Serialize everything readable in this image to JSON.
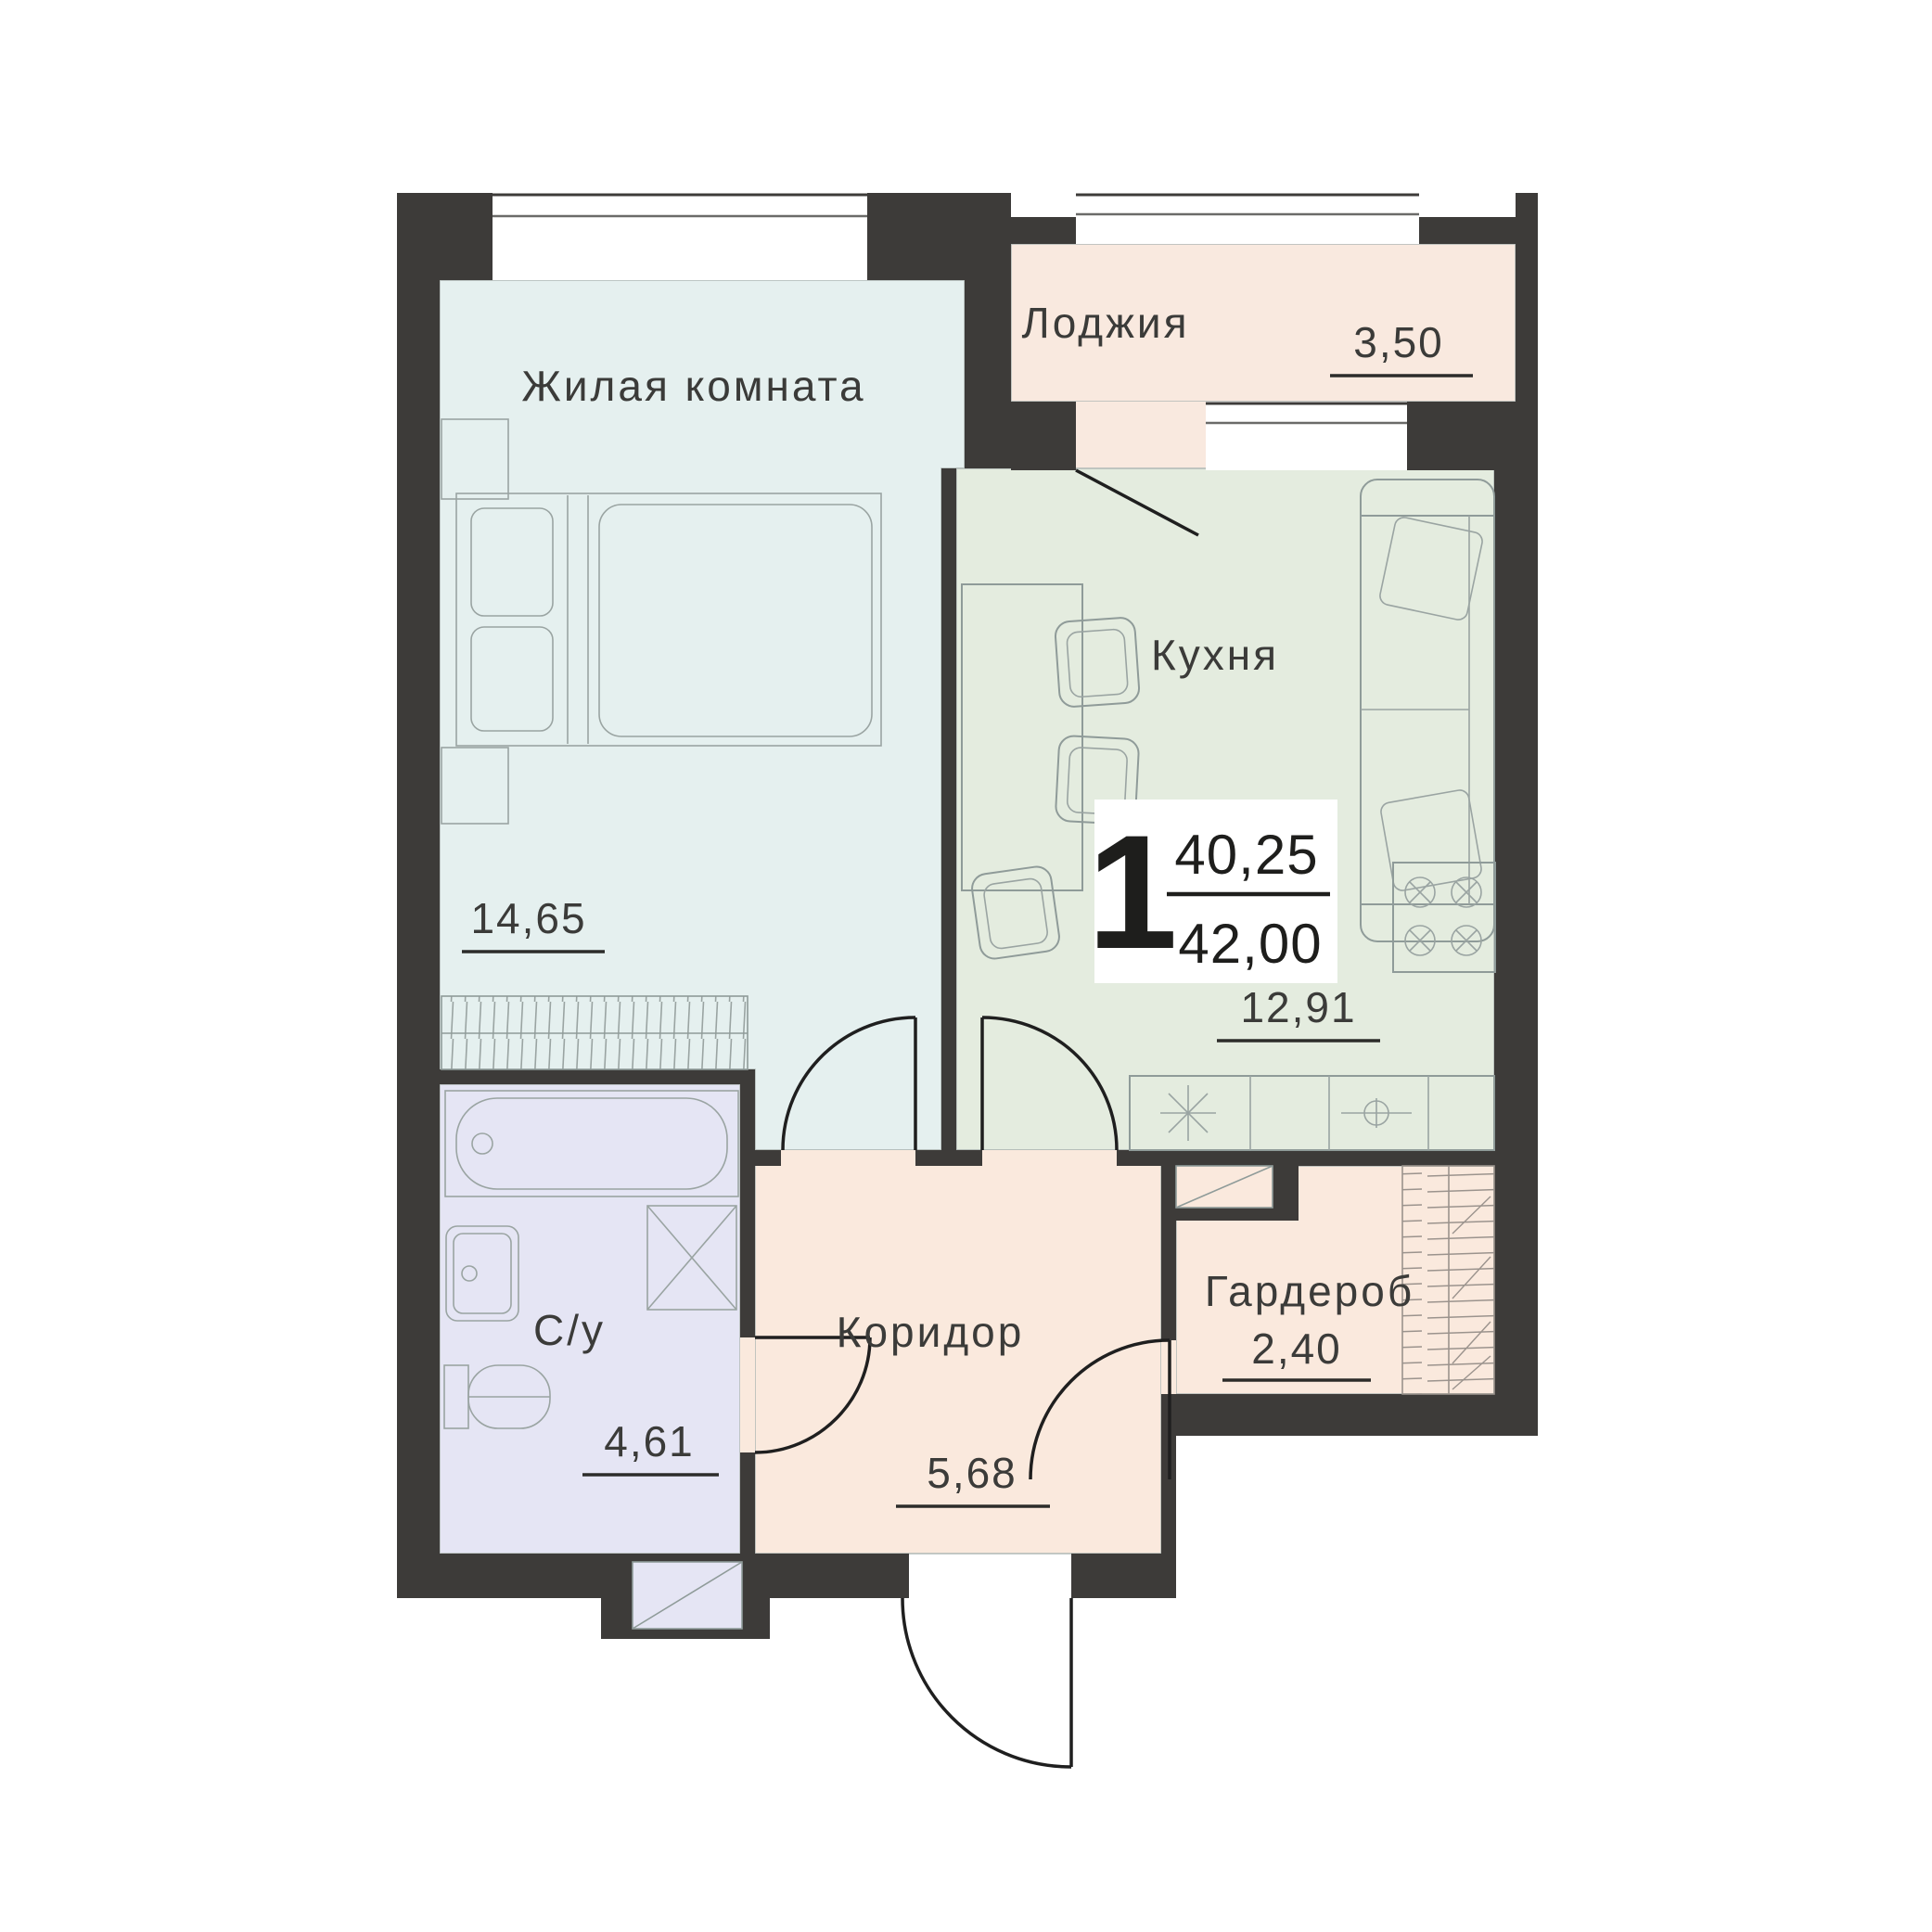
{
  "plan": {
    "type": "apartment-floor-plan",
    "language": "ru",
    "rooms": [
      {
        "id": "living",
        "name": "Жилая комната",
        "area": "14,65"
      },
      {
        "id": "loggia",
        "name": "Лоджия",
        "area": "3,50"
      },
      {
        "id": "kitchen",
        "name": "Кухня",
        "area": "12,91"
      },
      {
        "id": "bathroom",
        "name": "С/у",
        "area": "4,61"
      },
      {
        "id": "corridor",
        "name": "Коридор",
        "area": "5,68"
      },
      {
        "id": "wardrobe",
        "name": "Гардероб",
        "area": "2,40"
      }
    ],
    "badge": {
      "rooms_count": "1",
      "area_upper": "40,25",
      "area_lower": "42,00"
    },
    "colors": {
      "wall": "#3d3b39",
      "living": "#e5f0ef",
      "kitchen": "#e4ecdf",
      "loggia": "#f9e9df",
      "corridor": "#fae9dd",
      "wardrobe": "#fae9dd",
      "bathroom": "#e5e5f4",
      "window": "#ffffff"
    }
  }
}
